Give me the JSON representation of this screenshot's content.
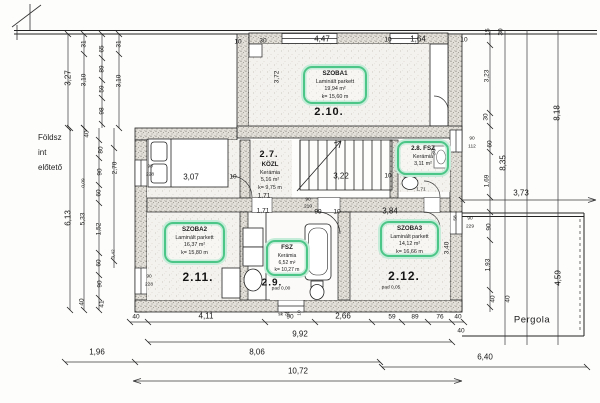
{
  "colors": {
    "highlight_green": "#4cc687",
    "ink": "#1c1c1c",
    "paper": "#ffffff"
  },
  "drawing": {
    "side_note": [
      "Földsz",
      "int",
      "előtető"
    ],
    "pergola_label": "Pergola",
    "rooms": [
      {
        "number": "2.10.",
        "lines": [
          "SZOBA1",
          "Laminált parkett",
          "19,94 m²",
          "k= 15,60 m"
        ],
        "highlight": true
      },
      {
        "number": "2.7.",
        "lines": [
          "KÖZL",
          "Kerámia",
          "5,16 m²",
          "k= 9,75 m"
        ],
        "highlight": false
      },
      {
        "number": "2.8.",
        "lines": [
          "2.8. FSZ",
          "Kerámia",
          "3,11 m²"
        ],
        "highlight": true
      },
      {
        "number": "2.9.",
        "lines": [
          "FSZ",
          "Kerámia",
          "6,52 m²",
          "k= 10,27 m"
        ],
        "highlight": true
      },
      {
        "number": "2.11.",
        "lines": [
          "SZOBA2",
          "Laminált parkett",
          "16,37 m²",
          "k= 15,80 m"
        ],
        "highlight": true
      },
      {
        "number": "2.12.",
        "lines": [
          "SZOBA3",
          "Laminált parkett",
          "14,12 m²",
          "k= 16,66 m"
        ],
        "highlight": true
      }
    ],
    "dim_labels": [
      {
        "t": "10",
        "x": 238,
        "y": 42
      },
      {
        "t": "30",
        "x": 263,
        "y": 41
      },
      {
        "t": "4,47",
        "x": 322,
        "y": 39,
        "lg": 1
      },
      {
        "t": "10",
        "x": 388,
        "y": 40
      },
      {
        "t": "1,64",
        "x": 418,
        "y": 39,
        "lg": 1
      },
      {
        "t": "10",
        "x": 464,
        "y": 40
      },
      {
        "t": "15",
        "x": 488,
        "y": 32,
        "r": 1
      },
      {
        "t": "30",
        "x": 501,
        "y": 32,
        "r": 1
      },
      {
        "t": "3,27",
        "x": 68,
        "y": 78,
        "r": 1,
        "lg": 1
      },
      {
        "t": "31",
        "x": 84,
        "y": 44,
        "r": 1
      },
      {
        "t": "3,10",
        "x": 84,
        "y": 80,
        "r": 1
      },
      {
        "t": "65",
        "x": 102,
        "y": 49,
        "r": 1
      },
      {
        "t": "89",
        "x": 102,
        "y": 69,
        "r": 1
      },
      {
        "t": "59",
        "x": 102,
        "y": 89,
        "r": 1
      },
      {
        "t": "98",
        "x": 102,
        "y": 111,
        "r": 1
      },
      {
        "t": "31",
        "x": 119,
        "y": 44,
        "r": 1
      },
      {
        "t": "3,10",
        "x": 119,
        "y": 81,
        "r": 1
      },
      {
        "t": "40",
        "x": 87,
        "y": 134,
        "r": 1
      },
      {
        "t": "80",
        "x": 101,
        "y": 150,
        "r": 1
      },
      {
        "t": "90",
        "x": 100,
        "y": 172,
        "r": 1
      },
      {
        "t": "0,09",
        "x": 84,
        "y": 183,
        "r": 1,
        "s": 1
      },
      {
        "t": "2,70",
        "x": 115,
        "y": 168,
        "r": 1
      },
      {
        "t": "60",
        "x": 99,
        "y": 193,
        "r": 1
      },
      {
        "t": "6,13",
        "x": 68,
        "y": 218,
        "r": 1,
        "lg": 1
      },
      {
        "t": "5,33",
        "x": 83,
        "y": 219,
        "r": 1
      },
      {
        "t": "1,52",
        "x": 99,
        "y": 229,
        "r": 1
      },
      {
        "t": "3,42",
        "x": 114,
        "y": 254,
        "r": 1,
        "s": 1
      },
      {
        "t": "60",
        "x": 99,
        "y": 263,
        "r": 1
      },
      {
        "t": "90",
        "x": 100,
        "y": 284,
        "r": 1
      },
      {
        "t": "40",
        "x": 82,
        "y": 302,
        "r": 1
      },
      {
        "t": "41",
        "x": 102,
        "y": 304,
        "r": 1
      },
      {
        "t": "3,23",
        "x": 487,
        "y": 76,
        "r": 1
      },
      {
        "t": "30",
        "x": 486,
        "y": 117,
        "r": 1
      },
      {
        "t": "60",
        "x": 490,
        "y": 144,
        "r": 1
      },
      {
        "t": "8,35",
        "x": 503,
        "y": 163,
        "r": 1,
        "lg": 1
      },
      {
        "t": "8,18",
        "x": 557,
        "y": 113,
        "r": 1,
        "lg": 1
      },
      {
        "t": "1,69",
        "x": 487,
        "y": 181,
        "r": 1
      },
      {
        "t": "3,73",
        "x": 521,
        "y": 193,
        "lg": 1
      },
      {
        "t": "90",
        "x": 489,
        "y": 227,
        "r": 1
      },
      {
        "t": "1,93",
        "x": 488,
        "y": 265,
        "r": 1
      },
      {
        "t": "40",
        "x": 493,
        "y": 299,
        "r": 1
      },
      {
        "t": "40",
        "x": 508,
        "y": 299,
        "r": 1
      },
      {
        "t": "4,59",
        "x": 558,
        "y": 278,
        "r": 1,
        "lg": 1
      },
      {
        "t": "90",
        "x": 308,
        "y": 200,
        "s": 1
      },
      {
        "t": "210",
        "x": 308,
        "y": 207,
        "s": 1
      },
      {
        "t": "90",
        "x": 472,
        "y": 139,
        "s": 1
      },
      {
        "t": "112",
        "x": 472,
        "y": 147,
        "s": 1
      },
      {
        "t": "90",
        "x": 470,
        "y": 219,
        "s": 1
      },
      {
        "t": "229",
        "x": 470,
        "y": 227,
        "s": 1
      },
      {
        "t": "90",
        "x": 150,
        "y": 167,
        "s": 1
      },
      {
        "t": "228",
        "x": 150,
        "y": 175,
        "s": 1
      },
      {
        "t": "90",
        "x": 149,
        "y": 277,
        "s": 1
      },
      {
        "t": "228",
        "x": 149,
        "y": 285,
        "s": 1
      },
      {
        "t": "pad 0,00",
        "x": 281,
        "y": 289,
        "s": 1
      },
      {
        "t": "pad 0,05",
        "x": 391,
        "y": 288,
        "s": 1
      },
      {
        "t": "sk 75",
        "x": 284,
        "y": 315,
        "s": 1
      },
      {
        "t": "10",
        "x": 300,
        "y": 313,
        "r": 1,
        "s": 1
      },
      {
        "t": "3,07",
        "x": 191,
        "y": 177,
        "lg": 1
      },
      {
        "t": "10",
        "x": 233,
        "y": 177
      },
      {
        "t": "3,22",
        "x": 341,
        "y": 176,
        "lg": 1
      },
      {
        "t": "10",
        "x": 388,
        "y": 176
      },
      {
        "t": "30",
        "x": 434,
        "y": 152,
        "r": 1
      },
      {
        "t": "1,71",
        "x": 264,
        "y": 196
      },
      {
        "t": "1,71",
        "x": 263,
        "y": 211
      },
      {
        "t": "99",
        "x": 318,
        "y": 212
      },
      {
        "t": "10",
        "x": 337,
        "y": 212
      },
      {
        "t": "3,84",
        "x": 390,
        "y": 211,
        "lg": 1
      },
      {
        "t": "1,71",
        "x": 421,
        "y": 190,
        "s": 1
      },
      {
        "t": "3,40",
        "x": 447,
        "y": 248,
        "r": 1
      },
      {
        "t": "58",
        "x": 456,
        "y": 218,
        "r": 1,
        "s": 1
      },
      {
        "t": "3,72",
        "x": 277,
        "y": 77,
        "r": 1
      },
      {
        "t": "40",
        "x": 136,
        "y": 317
      },
      {
        "t": "4,11",
        "x": 206,
        "y": 316,
        "lg": 1
      },
      {
        "t": "90",
        "x": 290,
        "y": 317
      },
      {
        "t": "2,66",
        "x": 343,
        "y": 316,
        "lg": 1
      },
      {
        "t": "59",
        "x": 392,
        "y": 317
      },
      {
        "t": "89",
        "x": 415,
        "y": 317
      },
      {
        "t": "76",
        "x": 440,
        "y": 317
      },
      {
        "t": "40",
        "x": 458,
        "y": 317
      },
      {
        "t": "40",
        "x": 461,
        "y": 331
      },
      {
        "t": "9,92",
        "x": 300,
        "y": 334,
        "lg": 1
      },
      {
        "t": "1,96",
        "x": 97,
        "y": 352,
        "lg": 1
      },
      {
        "t": "8,06",
        "x": 257,
        "y": 352,
        "lg": 1
      },
      {
        "t": "6,40",
        "x": 485,
        "y": 357,
        "lg": 1
      },
      {
        "t": "10,72",
        "x": 298,
        "y": 371,
        "lg": 1
      }
    ]
  }
}
